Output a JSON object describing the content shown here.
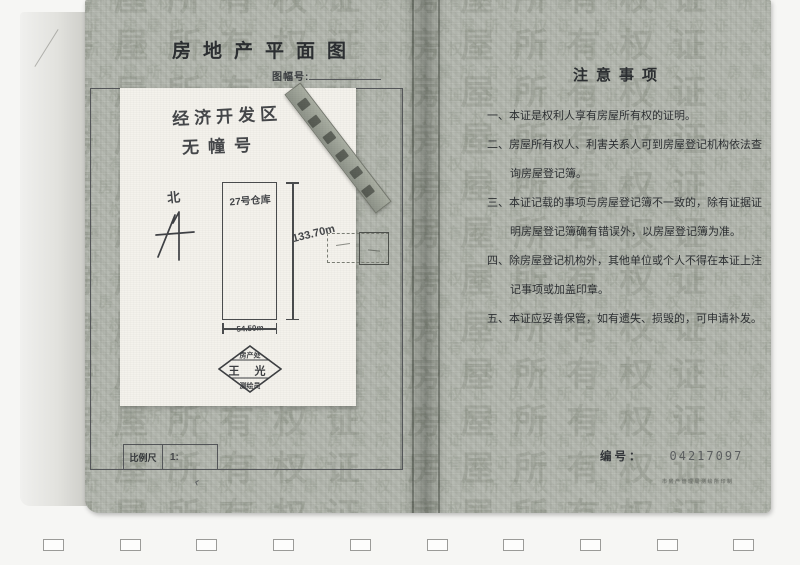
{
  "left_page": {
    "title": "房地产平面图",
    "map_sheet_label": "图幅号:",
    "location_line1": "经济开发区",
    "location_line2": "无幢号",
    "north_label": "北",
    "building_label": "27号仓库",
    "dim_height": "133.70m",
    "dim_width": "54.50m",
    "stamp": {
      "top": "房产处",
      "name": "王 光",
      "bottom": "测绘员"
    },
    "scale_label": "比例尺",
    "scale_value": "1:",
    "check_mark": "‹"
  },
  "right_page": {
    "title": "注意事项",
    "items": [
      "一、本证是权利人享有房屋所有权的证明。",
      "二、房屋所有权人、利害关系人可到房屋登记机构依法查询房屋登记簿。",
      "三、本证记载的事项与房屋登记簿不一致的，除有证据证明房屋登记簿确有错误外，以房屋登记簿为准。",
      "四、除房屋登记机构外，其他单位或个人不得在本证上注记事项或加盖印章。",
      "五、本证应妥善保管，如有遗失、损毁的，可申请补发。"
    ],
    "serial_label": "编号：",
    "serial_number": "04217097",
    "fine_print": "市房产管理局测绘所印制"
  },
  "watermark_text": "房屋所有权证 ",
  "colors": {
    "page": "#b4b8af",
    "paper": "#f4f2ec",
    "ink": "#2e3134"
  }
}
